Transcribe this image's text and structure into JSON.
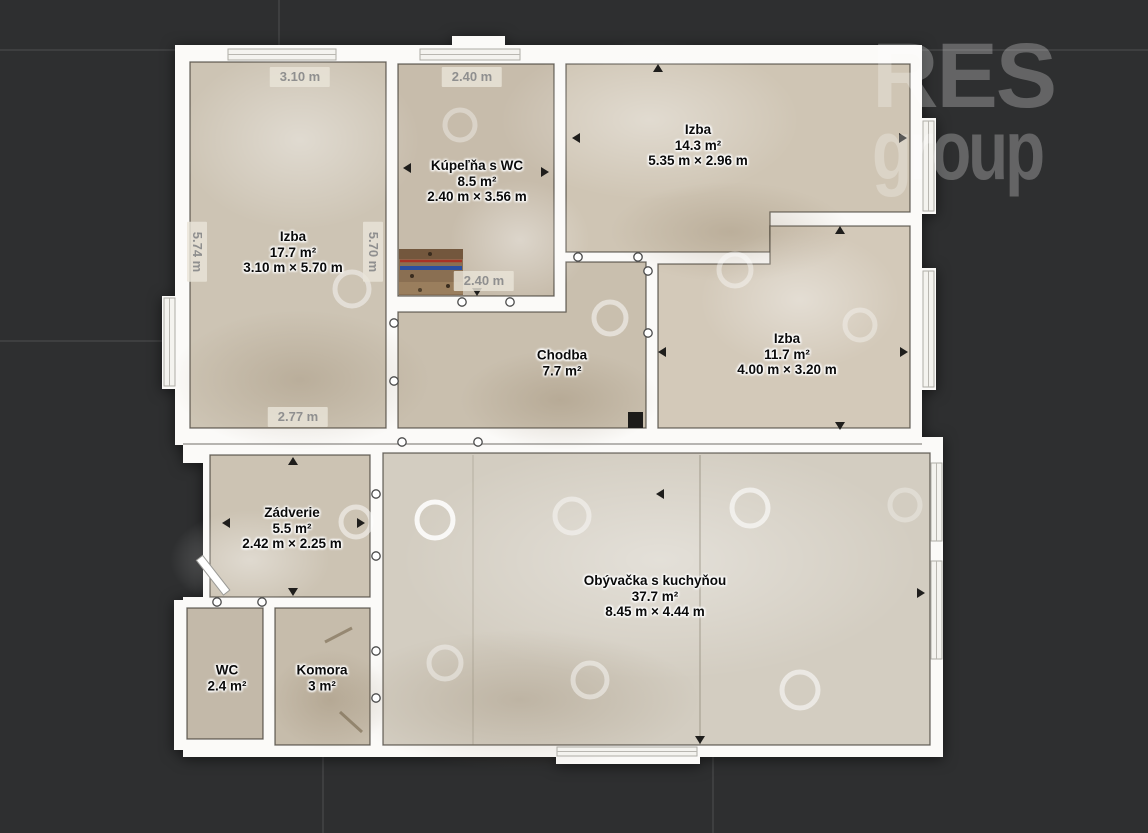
{
  "watermark": {
    "line1": "RES",
    "line2": "group"
  },
  "rooms": [
    {
      "id": "izba-1",
      "name": "Izba",
      "area": "17.7 m²",
      "dims": "3.10 m × 5.70 m"
    },
    {
      "id": "kupelna",
      "name": "Kúpeľňa s WC",
      "area": "8.5 m²",
      "dims": "2.40 m × 3.56 m"
    },
    {
      "id": "izba-2",
      "name": "Izba",
      "area": "14.3 m²",
      "dims": "5.35 m × 2.96 m"
    },
    {
      "id": "izba-3",
      "name": "Izba",
      "area": "11.7 m²",
      "dims": "4.00 m × 3.20 m"
    },
    {
      "id": "chodba",
      "name": "Chodba",
      "area": "7.7 m²",
      "dims": ""
    },
    {
      "id": "zadverie",
      "name": "Zádverie",
      "area": "5.5 m²",
      "dims": "2.42 m × 2.25 m"
    },
    {
      "id": "obyvacka",
      "name": "Obývačka s kuchyňou",
      "area": "37.7 m²",
      "dims": "8.45 m × 4.44 m"
    },
    {
      "id": "wc",
      "name": "WC",
      "area": "2.4 m²",
      "dims": ""
    },
    {
      "id": "komora",
      "name": "Komora",
      "area": "3 m²",
      "dims": ""
    }
  ],
  "dimensions": [
    {
      "id": "dim-width-izba1",
      "label": "3.10 m"
    },
    {
      "id": "dim-width-kupelna",
      "label": "2.40 m"
    },
    {
      "id": "dim-height-left",
      "label": "5.74 m"
    },
    {
      "id": "dim-height-izba1",
      "label": "5.70 m"
    },
    {
      "id": "dim-bottom-izba1",
      "label": "2.77 m"
    },
    {
      "id": "dim-bottom-kupelna",
      "label": "2.40 m"
    }
  ],
  "colors": {
    "background": "#2e2f30",
    "tile_seam": "#3e3f40",
    "wall": "#fbfaf8",
    "floor": "#cdc4b4",
    "floor_light": "#d3cdc1",
    "label_text": "#0a0a0a",
    "dim_text": "#8f8f8f",
    "watermark": "#6b6d6e",
    "pipe_blue": "#2a4fa0",
    "pipe_red": "#a83226"
  }
}
